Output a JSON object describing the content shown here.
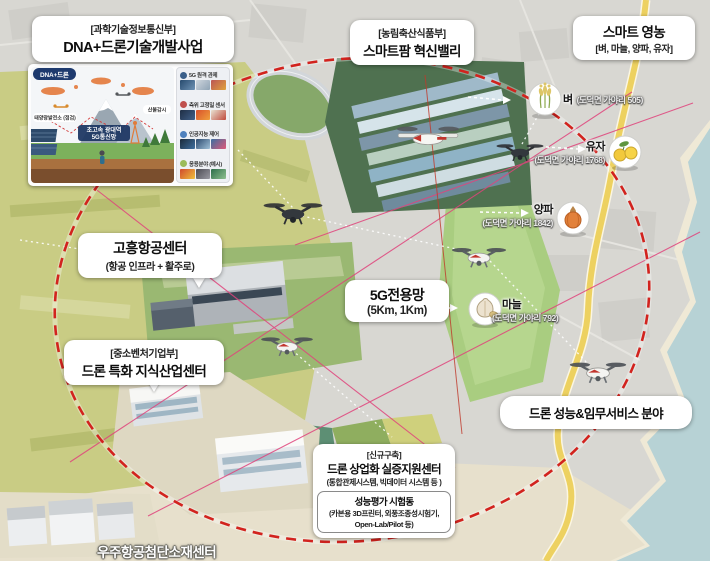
{
  "boxes": {
    "msit": {
      "ministry": "[과학기술정보통신부]",
      "title": "DNA+드론기술개발사업"
    },
    "mafra": {
      "ministry": "[농림축산식품부]",
      "title": "스마트팜 혁신밸리"
    },
    "smart_farming": {
      "title": "스마트 영농",
      "subtitle": "[벼, 마늘, 양파, 유자]"
    },
    "aviation": {
      "title": "고흥항공센터",
      "subtitle": "(항공 인프라 + 활주로)"
    },
    "smes": {
      "ministry": "[중소벤처기업부]",
      "title": "드론 특화 지식산업센터"
    },
    "network": {
      "title": "5G전용망",
      "subtitle": "(5Km, 1Km)"
    },
    "service": {
      "title": "드론 성능&임무서비스 분야"
    },
    "commercial": {
      "tag": "[신규구축]",
      "title": "드론 상업화 실증지원센터",
      "subtitle": "(통합관제시스템, 빅데이터 시스템 등 )",
      "facility_title": "성능평가 시험동",
      "facility_line1": "(카본용 3D프린터, 외풍조종성시험기,",
      "facility_line2": "Open-Lab/Pilot 등)"
    },
    "materials": {
      "title": "우주항공첨단소재센터"
    }
  },
  "crops": [
    {
      "name": "벼",
      "address": "(도덕면 가야리 505)"
    },
    {
      "name": "유자",
      "address": "(도덕면 가야리 1768)"
    },
    {
      "name": "양파",
      "address": "(도덕면 가야리 1842)"
    },
    {
      "name": "마늘",
      "address": "(도덕면 가야리 792)"
    }
  ],
  "inset": {
    "badge": "DNA+드론",
    "scene": {
      "label_left": "태양광발전소 (점검)",
      "label_right": "산불감시",
      "center_line1": "초고속 광대역",
      "center_line2": "5G통신망"
    },
    "sidebar": [
      "5G 원격 관제",
      "측위 고정밀 센서",
      "인공지능 제어",
      "응용분야 (예시)"
    ]
  },
  "colors": {
    "coverage_dash": "#d2231e",
    "link_pink": "#e0447c",
    "road": "#edd160",
    "water": "#b7d2d5",
    "farm_green": "#4f7150"
  }
}
